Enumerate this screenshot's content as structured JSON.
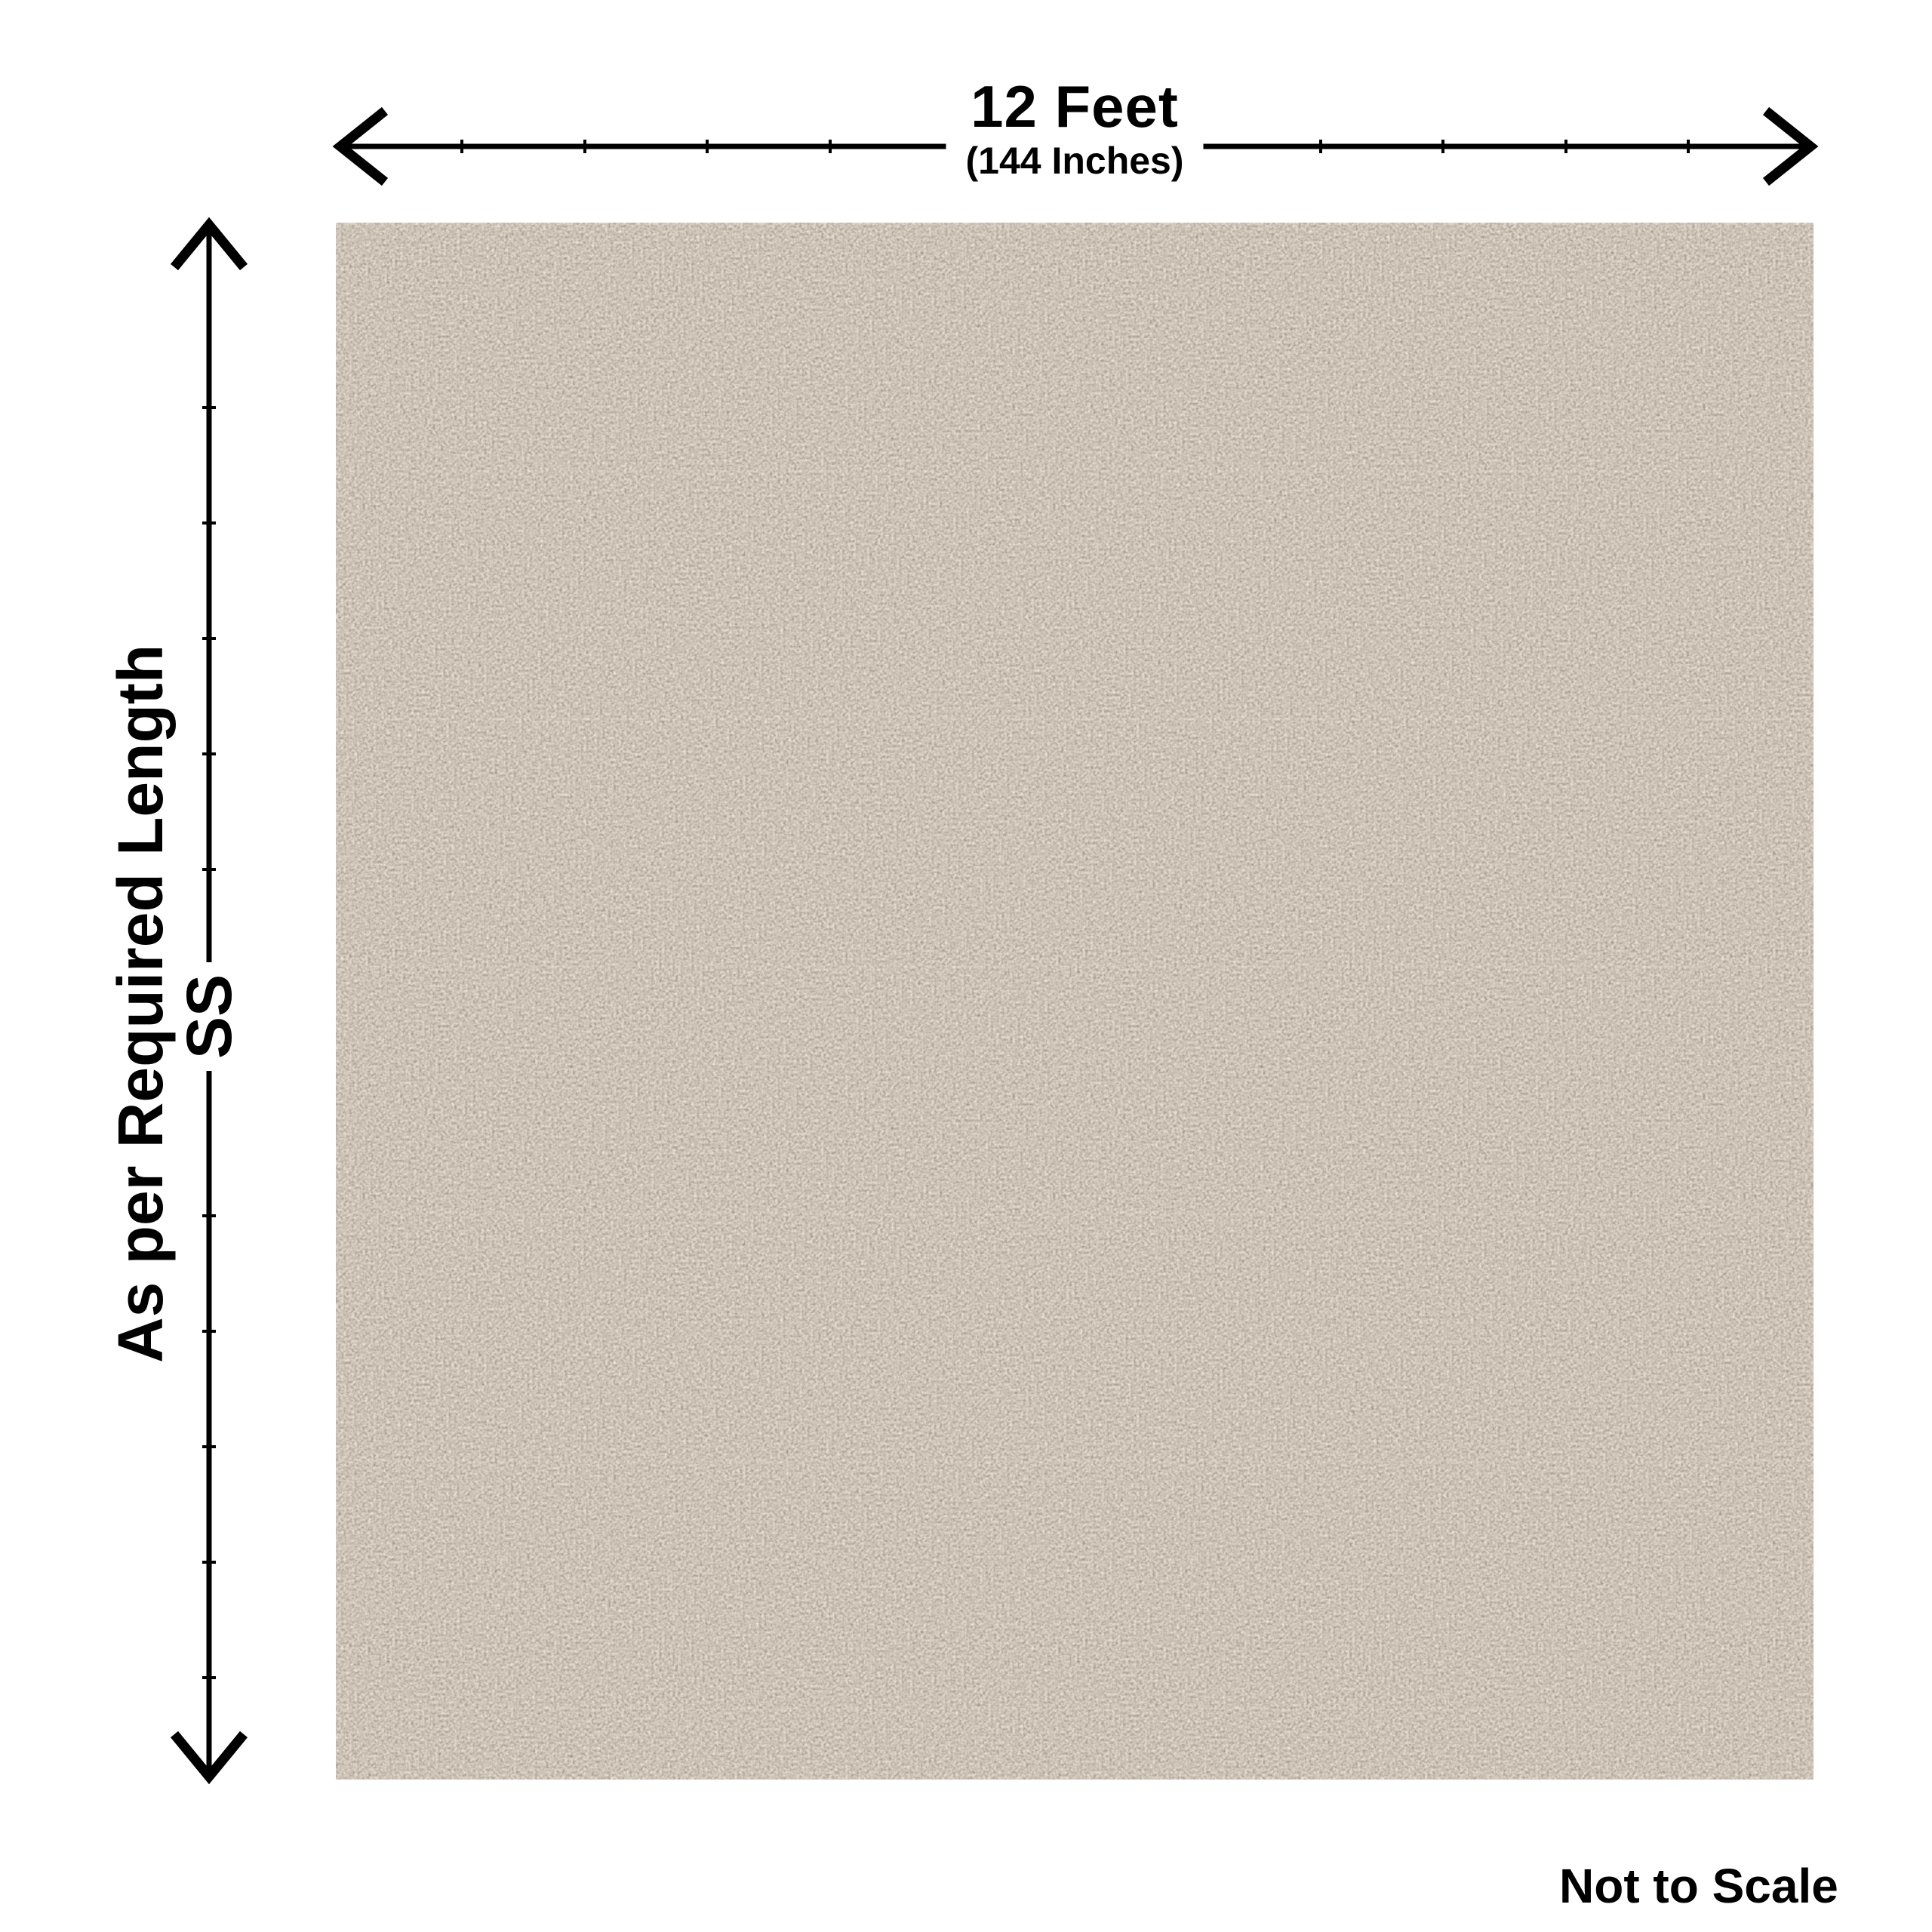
{
  "page": {
    "background_color": "#ffffff"
  },
  "diagram": {
    "width_dimension": {
      "label": "12 Feet",
      "sublabel": "(144 Inches)",
      "arrow_icon": "horizontal-double-arrow"
    },
    "height_dimension": {
      "label": "As per Required Length",
      "sublabel": "SS",
      "arrow_icon": "vertical-double-arrow"
    },
    "scale_note": "Not to Scale",
    "line_color": "#000000",
    "text_color": "#000000"
  },
  "carpet": {
    "base_color": "#9a8b77",
    "fleck_light_color": "#c6c1b5",
    "fleck_dark_color": "#6e5c49"
  }
}
